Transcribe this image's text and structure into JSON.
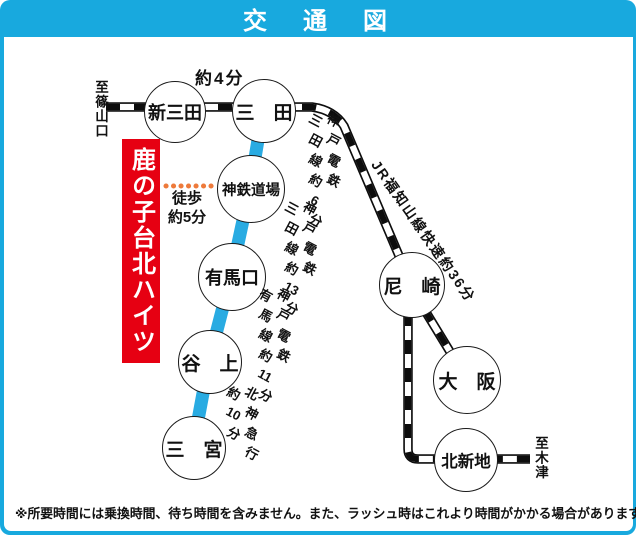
{
  "header": {
    "title": "交　通　図"
  },
  "colors": {
    "accent_blue": "#18a9de",
    "line_cyan": "#29abe2",
    "banner_red": "#e60012",
    "dot_orange": "#ee7a3b"
  },
  "destination": {
    "highlight": "鹿の子台北ハイツ"
  },
  "edge_labels": {
    "left": "至篠山口",
    "right": "至木津"
  },
  "stations": [
    {
      "id": "shin-sanda",
      "name": "新三田"
    },
    {
      "id": "sanda",
      "name": "三　田"
    },
    {
      "id": "shintetsu-dojo",
      "name": "神鉄道場"
    },
    {
      "id": "arimaguchi",
      "name": "有馬口"
    },
    {
      "id": "tanigami",
      "name": "谷　上"
    },
    {
      "id": "sannomiya",
      "name": "三　宮"
    },
    {
      "id": "amagasaki",
      "name": "尼　崎"
    },
    {
      "id": "osaka",
      "name": "大　阪"
    },
    {
      "id": "kitashinchi",
      "name": "北新地"
    }
  ],
  "segment_labels": {
    "sanda_interval": "約4分",
    "walk": "徒歩\n約5分",
    "kobe_sanda_6": "神戸電鉄\n三田線約6分",
    "kobe_sanda_13": "神戸電鉄\n三田線約13分",
    "kobe_arima_11": "神戸電鉄\n有馬線約11分",
    "hokushin_10": "北神急行\n約10分",
    "jr_fukuchiyama_36": "JR福知山線快速約36分"
  },
  "footnote": "※所要時間には乗換時間、待ち時間を含みません。また、ラッシュ時はこれより時間がかかる場合があります。"
}
